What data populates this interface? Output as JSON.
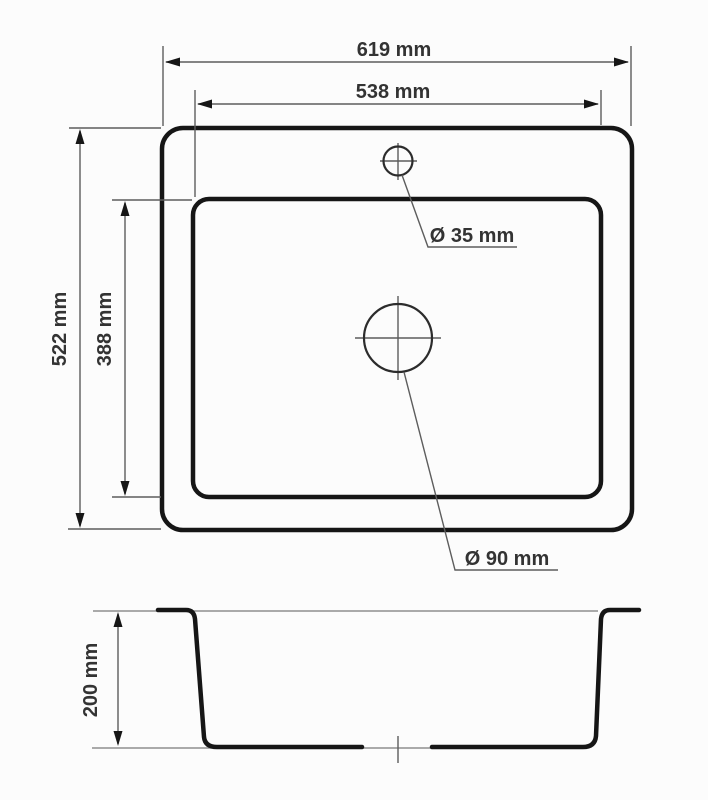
{
  "labels": {
    "outer_width": "619 mm",
    "inner_width": "538 mm",
    "outer_height": "522 mm",
    "inner_height": "388 mm",
    "bowl_depth": "200 mm",
    "faucet_hole_diameter": "Ø 35 mm",
    "drain_hole_diameter": "Ø 90 mm"
  },
  "dimensions_mm": {
    "outer_width": 619,
    "inner_width": 538,
    "outer_height": 522,
    "inner_height": 388,
    "bowl_depth": 200,
    "faucet_hole_diameter": 35,
    "drain_hole_diameter": 90
  },
  "colors": {
    "background": "#fcfcfc",
    "outline": "#161616",
    "dimension_line": "#5d5d5d",
    "text": "#333333"
  }
}
